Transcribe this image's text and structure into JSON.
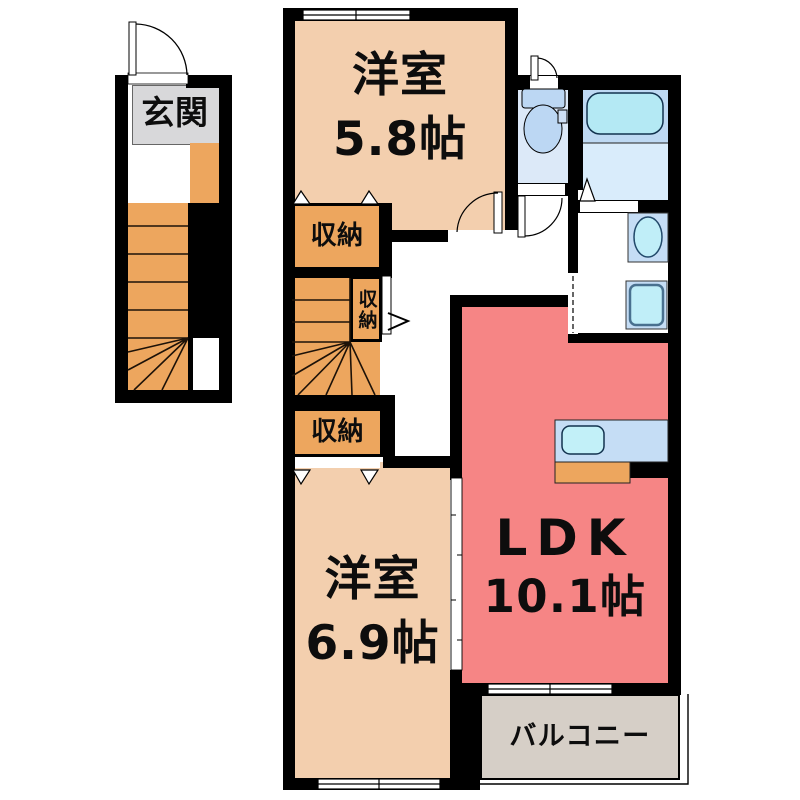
{
  "plan": {
    "entrance": {
      "label": "玄関"
    },
    "bedroom_top": {
      "name": "洋室",
      "size": "5.8帖"
    },
    "bedroom_bottom": {
      "name": "洋室",
      "size": "6.9帖"
    },
    "ldk": {
      "name": "LDK",
      "size": "10.1帖"
    },
    "balcony": {
      "label": "バルコニー"
    },
    "closet_top": {
      "label": "収納"
    },
    "closet_mid": {
      "label": "収納"
    },
    "closet_bottom": {
      "label": "収納"
    }
  },
  "colors": {
    "room_peach": "#f3cfae",
    "closet_orange": "#eda65e",
    "ldk_red": "#f68585",
    "balcony_gray": "#d6cfc7",
    "entrance_gray": "#d8d8da",
    "toilet_room_blue": "#dce9f8",
    "bath_blue": "#bed9f3",
    "bath_lower_blue": "#d9ecfb",
    "bathtub_cyan": "#b4e9f4",
    "fixture_panel_blue": "#c5ddf5",
    "sink_cyan": "#c0eef8",
    "wall_black": "#000000"
  }
}
